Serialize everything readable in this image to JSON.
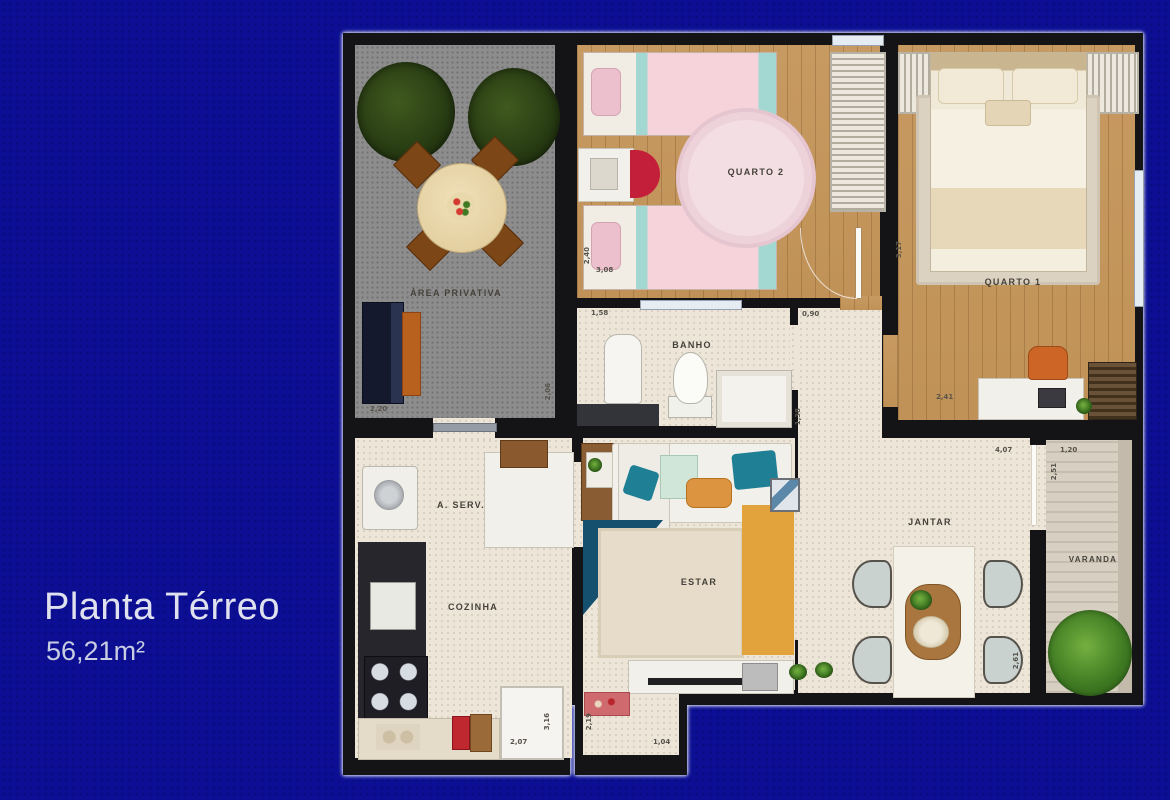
{
  "title": {
    "name": "Planta Térreo",
    "area": "56,21m²"
  },
  "rooms": [
    {
      "id": "area-privativa",
      "label": "ÁREA PRIVATIVA"
    },
    {
      "id": "quarto-2",
      "label": "QUARTO 2"
    },
    {
      "id": "quarto-1",
      "label": "QUARTO 1"
    },
    {
      "id": "banho",
      "label": "BANHO"
    },
    {
      "id": "a-serv",
      "label": "A. SERV."
    },
    {
      "id": "cozinha",
      "label": "COZINHA"
    },
    {
      "id": "estar",
      "label": "ESTAR"
    },
    {
      "id": "jantar",
      "label": "JANTAR"
    },
    {
      "id": "varanda",
      "label": "VARANDA"
    }
  ],
  "dims": [
    {
      "text": "2,20"
    },
    {
      "text": "2,06"
    },
    {
      "text": "1,58"
    },
    {
      "text": "2,40"
    },
    {
      "text": "3,08"
    },
    {
      "text": "0,90"
    },
    {
      "text": "3,17"
    },
    {
      "text": "2,41"
    },
    {
      "text": "1,38"
    },
    {
      "text": "4,07"
    },
    {
      "text": "1,20"
    },
    {
      "text": "2,51"
    },
    {
      "text": "2,61"
    },
    {
      "text": "2,07"
    },
    {
      "text": "3,16"
    },
    {
      "text": "2,19"
    },
    {
      "text": "1,04"
    }
  ],
  "colors": {
    "background": "#0c0e94",
    "wall": "#141416",
    "wood_floor": "#c79a62",
    "tile_floor": "#ece5d8",
    "patio_floor": "#8d8d8d",
    "accent_teal": "#1f7f95",
    "accent_orange": "#e3a33c",
    "accent_pink": "#f6d3da",
    "accent_red": "#c41f3a",
    "title_text": "#dfe2ee"
  }
}
